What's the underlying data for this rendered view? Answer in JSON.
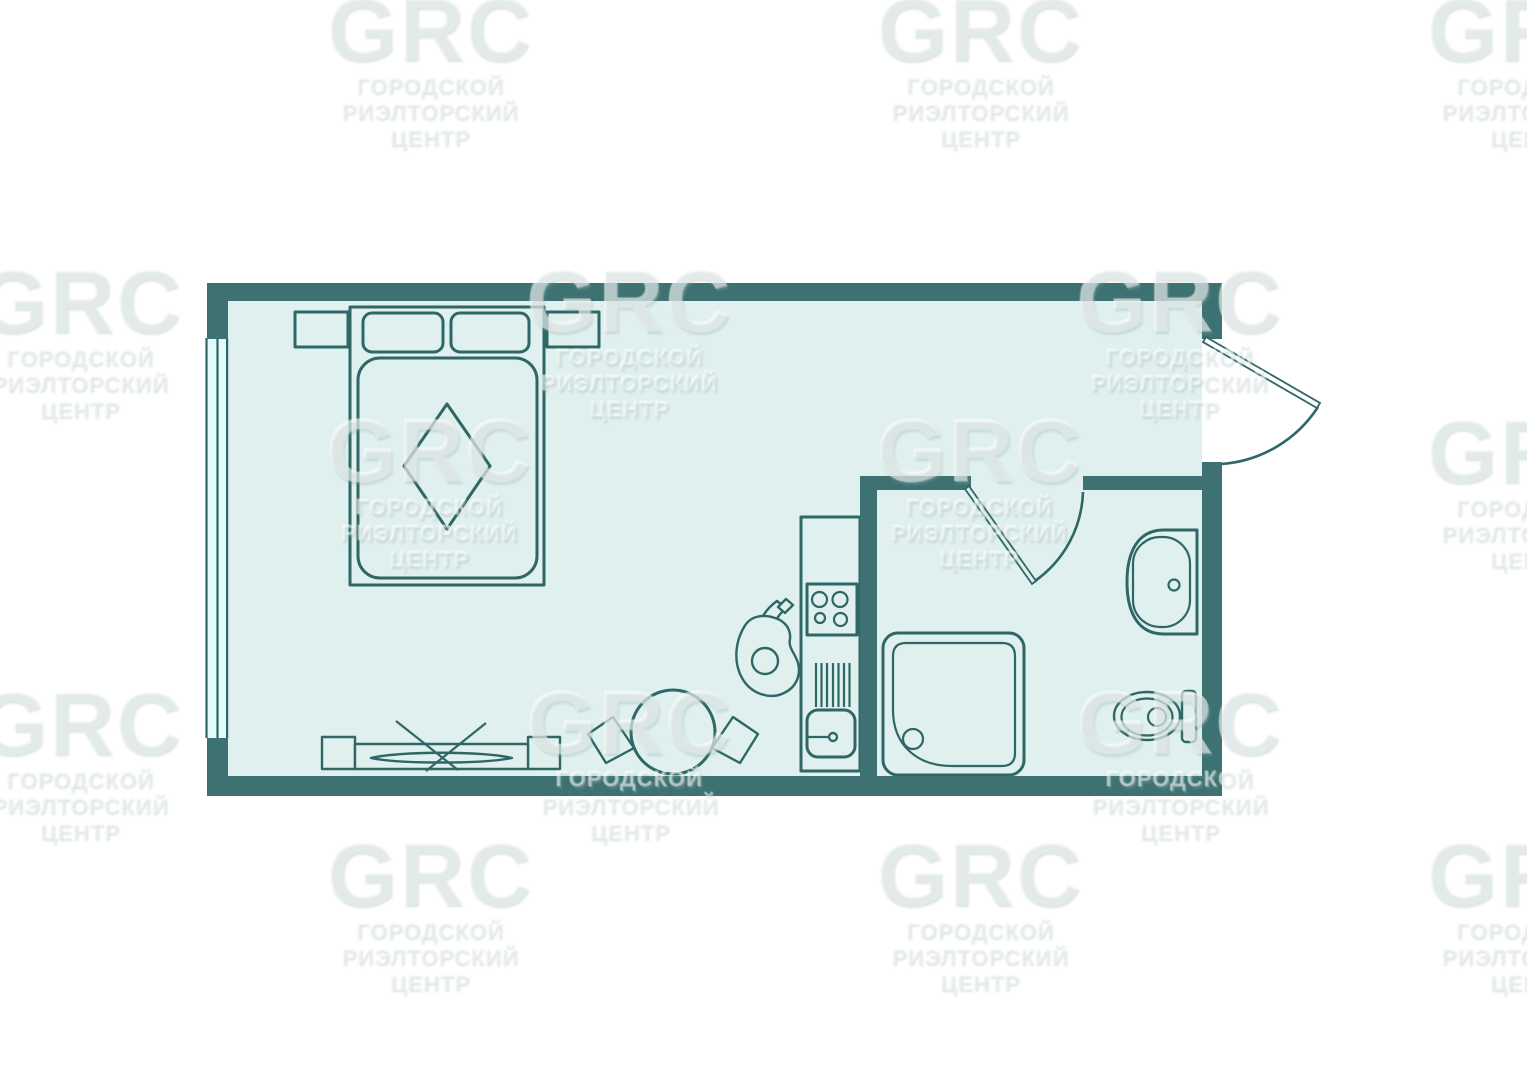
{
  "watermark": {
    "brand": "GRC",
    "line1": "ГОРОДСКОЙ",
    "line2": "РИЭЛТОРСКИЙ",
    "line3": "ЦЕНТР",
    "tiles": [
      {
        "x": 430,
        "y": 3
      },
      {
        "x": 980,
        "y": 3
      },
      {
        "x": 1530,
        "y": 3
      },
      {
        "x": 80,
        "y": 275
      },
      {
        "x": 630,
        "y": 275
      },
      {
        "x": 1180,
        "y": 275
      },
      {
        "x": 430,
        "y": 425
      },
      {
        "x": 980,
        "y": 425
      },
      {
        "x": 1530,
        "y": 425
      },
      {
        "x": 80,
        "y": 697
      },
      {
        "x": 630,
        "y": 697
      },
      {
        "x": 1180,
        "y": 697
      },
      {
        "x": 430,
        "y": 848
      },
      {
        "x": 980,
        "y": 848
      },
      {
        "x": 1530,
        "y": 848
      }
    ]
  },
  "colors": {
    "background": "#ffffff",
    "wall": "#3e7272",
    "floor": "#dff0ee",
    "outline": "#2f6666",
    "glass": "#e1fbfa",
    "door_leaf": "#ffffff",
    "watermark_text": "rgba(255,255,255,0.22)"
  },
  "legend": {
    "type": "studio-apartment-floor-plan",
    "rooms": [
      "living-sleeping-area",
      "bathroom"
    ],
    "items": [
      "double-bed",
      "pillow-left",
      "pillow-right",
      "mattress-diamond-blanket",
      "nightstand-left",
      "nightstand-right",
      "window",
      "tv-stand",
      "tv",
      "dining-table",
      "chair-left",
      "chair-right",
      "person-figure",
      "kitchen-block",
      "cooktop-4-burners",
      "dish-drainer",
      "kitchen-sink",
      "shower-tray",
      "washbasin",
      "toilet",
      "entry-door",
      "bathroom-door"
    ]
  }
}
